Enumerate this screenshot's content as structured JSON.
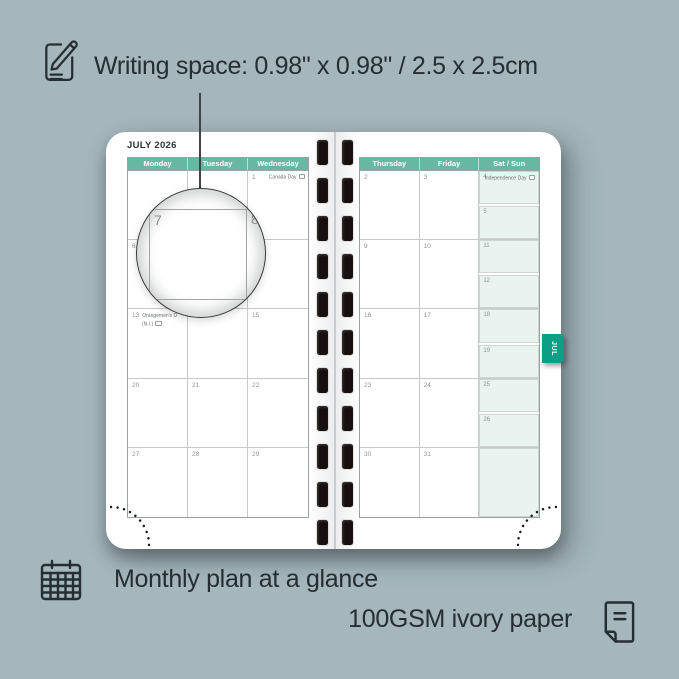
{
  "annotations": {
    "writing_space": "Writing space: 0.98\" x 0.98\" / 2.5 x 2.5cm",
    "monthly_glance": "Monthly plan at a glance",
    "paper": "100GSM ivory paper"
  },
  "planner": {
    "month_title": "JULY 2026",
    "tab_label": "JUL",
    "magnifier": {
      "left_day": "7",
      "right_day": "8"
    },
    "left_page": {
      "headers": [
        "Monday",
        "Tuesday",
        "Wednesday"
      ],
      "rows": [
        [
          {
            "n": ""
          },
          {
            "n": ""
          },
          {
            "n": "1",
            "holiday": "Canada Day",
            "flag": true,
            "layout": "right"
          }
        ],
        [
          {
            "n": "6"
          },
          {
            "n": "7"
          },
          {
            "n": "8"
          }
        ],
        [
          {
            "n": "13",
            "holiday": "Orangemen's D",
            "holiday2": "(N.I.)",
            "flag": true,
            "layout": "twoline"
          },
          {
            "n": "14"
          },
          {
            "n": "15"
          }
        ],
        [
          {
            "n": "20"
          },
          {
            "n": "21"
          },
          {
            "n": "22"
          }
        ],
        [
          {
            "n": "27"
          },
          {
            "n": "28"
          },
          {
            "n": "29"
          }
        ]
      ]
    },
    "right_page": {
      "headers": [
        "Thursday",
        "Friday",
        "Sat / Sun"
      ],
      "rows": [
        {
          "thu": "2",
          "fri": "3",
          "sat": {
            "n": "4",
            "holiday": "Independence Day",
            "flag": true
          },
          "sun": {
            "n": "5"
          }
        },
        {
          "thu": "9",
          "fri": "10",
          "sat": {
            "n": "11"
          },
          "sun": {
            "n": "12"
          }
        },
        {
          "thu": "16",
          "fri": "17",
          "sat": {
            "n": "18"
          },
          "sun": {
            "n": "19"
          }
        },
        {
          "thu": "23",
          "fri": "24",
          "sat": {
            "n": "25"
          },
          "sun": {
            "n": "26"
          }
        },
        {
          "thu": "30",
          "fri": "31",
          "satsun_merged": true
        }
      ]
    },
    "binding": {
      "holes_per_column": 11
    }
  },
  "colors": {
    "background": "#a5b6bd",
    "header_teal": "#66b8a3",
    "weekend_mint": "#e9f3ef",
    "tab_green": "#0b9f85",
    "ink": "#242e33",
    "day_number": "#8f9494"
  }
}
